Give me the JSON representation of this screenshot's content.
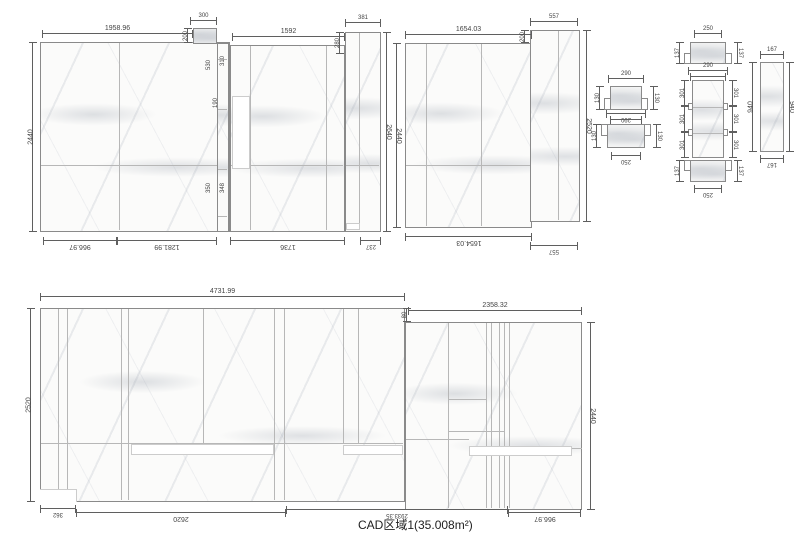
{
  "title": "CAD区域1(35.008m²)",
  "colors": {
    "panel_border": "#8a8a8a",
    "seam": "#b7b7b7",
    "dimension": "#5f5f5f",
    "marble_vein": "#a5acb8",
    "background": "#ffffff"
  },
  "dims": {
    "a_top": "1958.96",
    "a_left": "2440",
    "a_notch_w": "300",
    "a_notch_h": "200",
    "a_bottom_1": "966.97",
    "a_bottom_2": "1281.99",
    "strip_1": "530",
    "strip_2": "310",
    "strip_3": "190",
    "strip_4": "350",
    "strip_5": "348",
    "b_top": "1592",
    "b_col_top": "381",
    "b_col_rise": "280",
    "b_col_right": "2640",
    "b_bottom_1": "1736",
    "b_bottom_2": "237",
    "c_left": "2440",
    "c_top": "1654.03",
    "c_rise": "200",
    "c_col_top": "557",
    "c_col_right": "2520",
    "c_bottom": "1654.03",
    "c_col_bottom": "557",
    "m1_top": "290",
    "m1_left": "130",
    "m1_right": "130",
    "m1_bottom_1": "290",
    "m1_bottom_2": "250",
    "m2_left": "130",
    "m2_right": "130",
    "m2_bottom": "250",
    "r_cap_top": "250",
    "r_cap_left": "137",
    "r_cap_right": "137",
    "r_cap_bottom": "290",
    "r_col_top": "290",
    "r_seg_left": [
      "301",
      "301",
      "301"
    ],
    "r_seg_right": [
      "301",
      "301",
      "301"
    ],
    "r_cap2_left": "137",
    "r_cap2_right": "137",
    "r_cap2_bottom": "250",
    "s_top": "167",
    "s_left": "940",
    "s_right": "940",
    "s_bottom": "167",
    "d_top": "4731.99",
    "d_ext_top": "2358.32",
    "d_step": "80",
    "d_left": "2520",
    "d_right": "2440",
    "d_bottom_step": "362",
    "d_bottom_1": "2620",
    "d_bottom_2": "2933.35",
    "d_bottom_3": "966.97"
  }
}
